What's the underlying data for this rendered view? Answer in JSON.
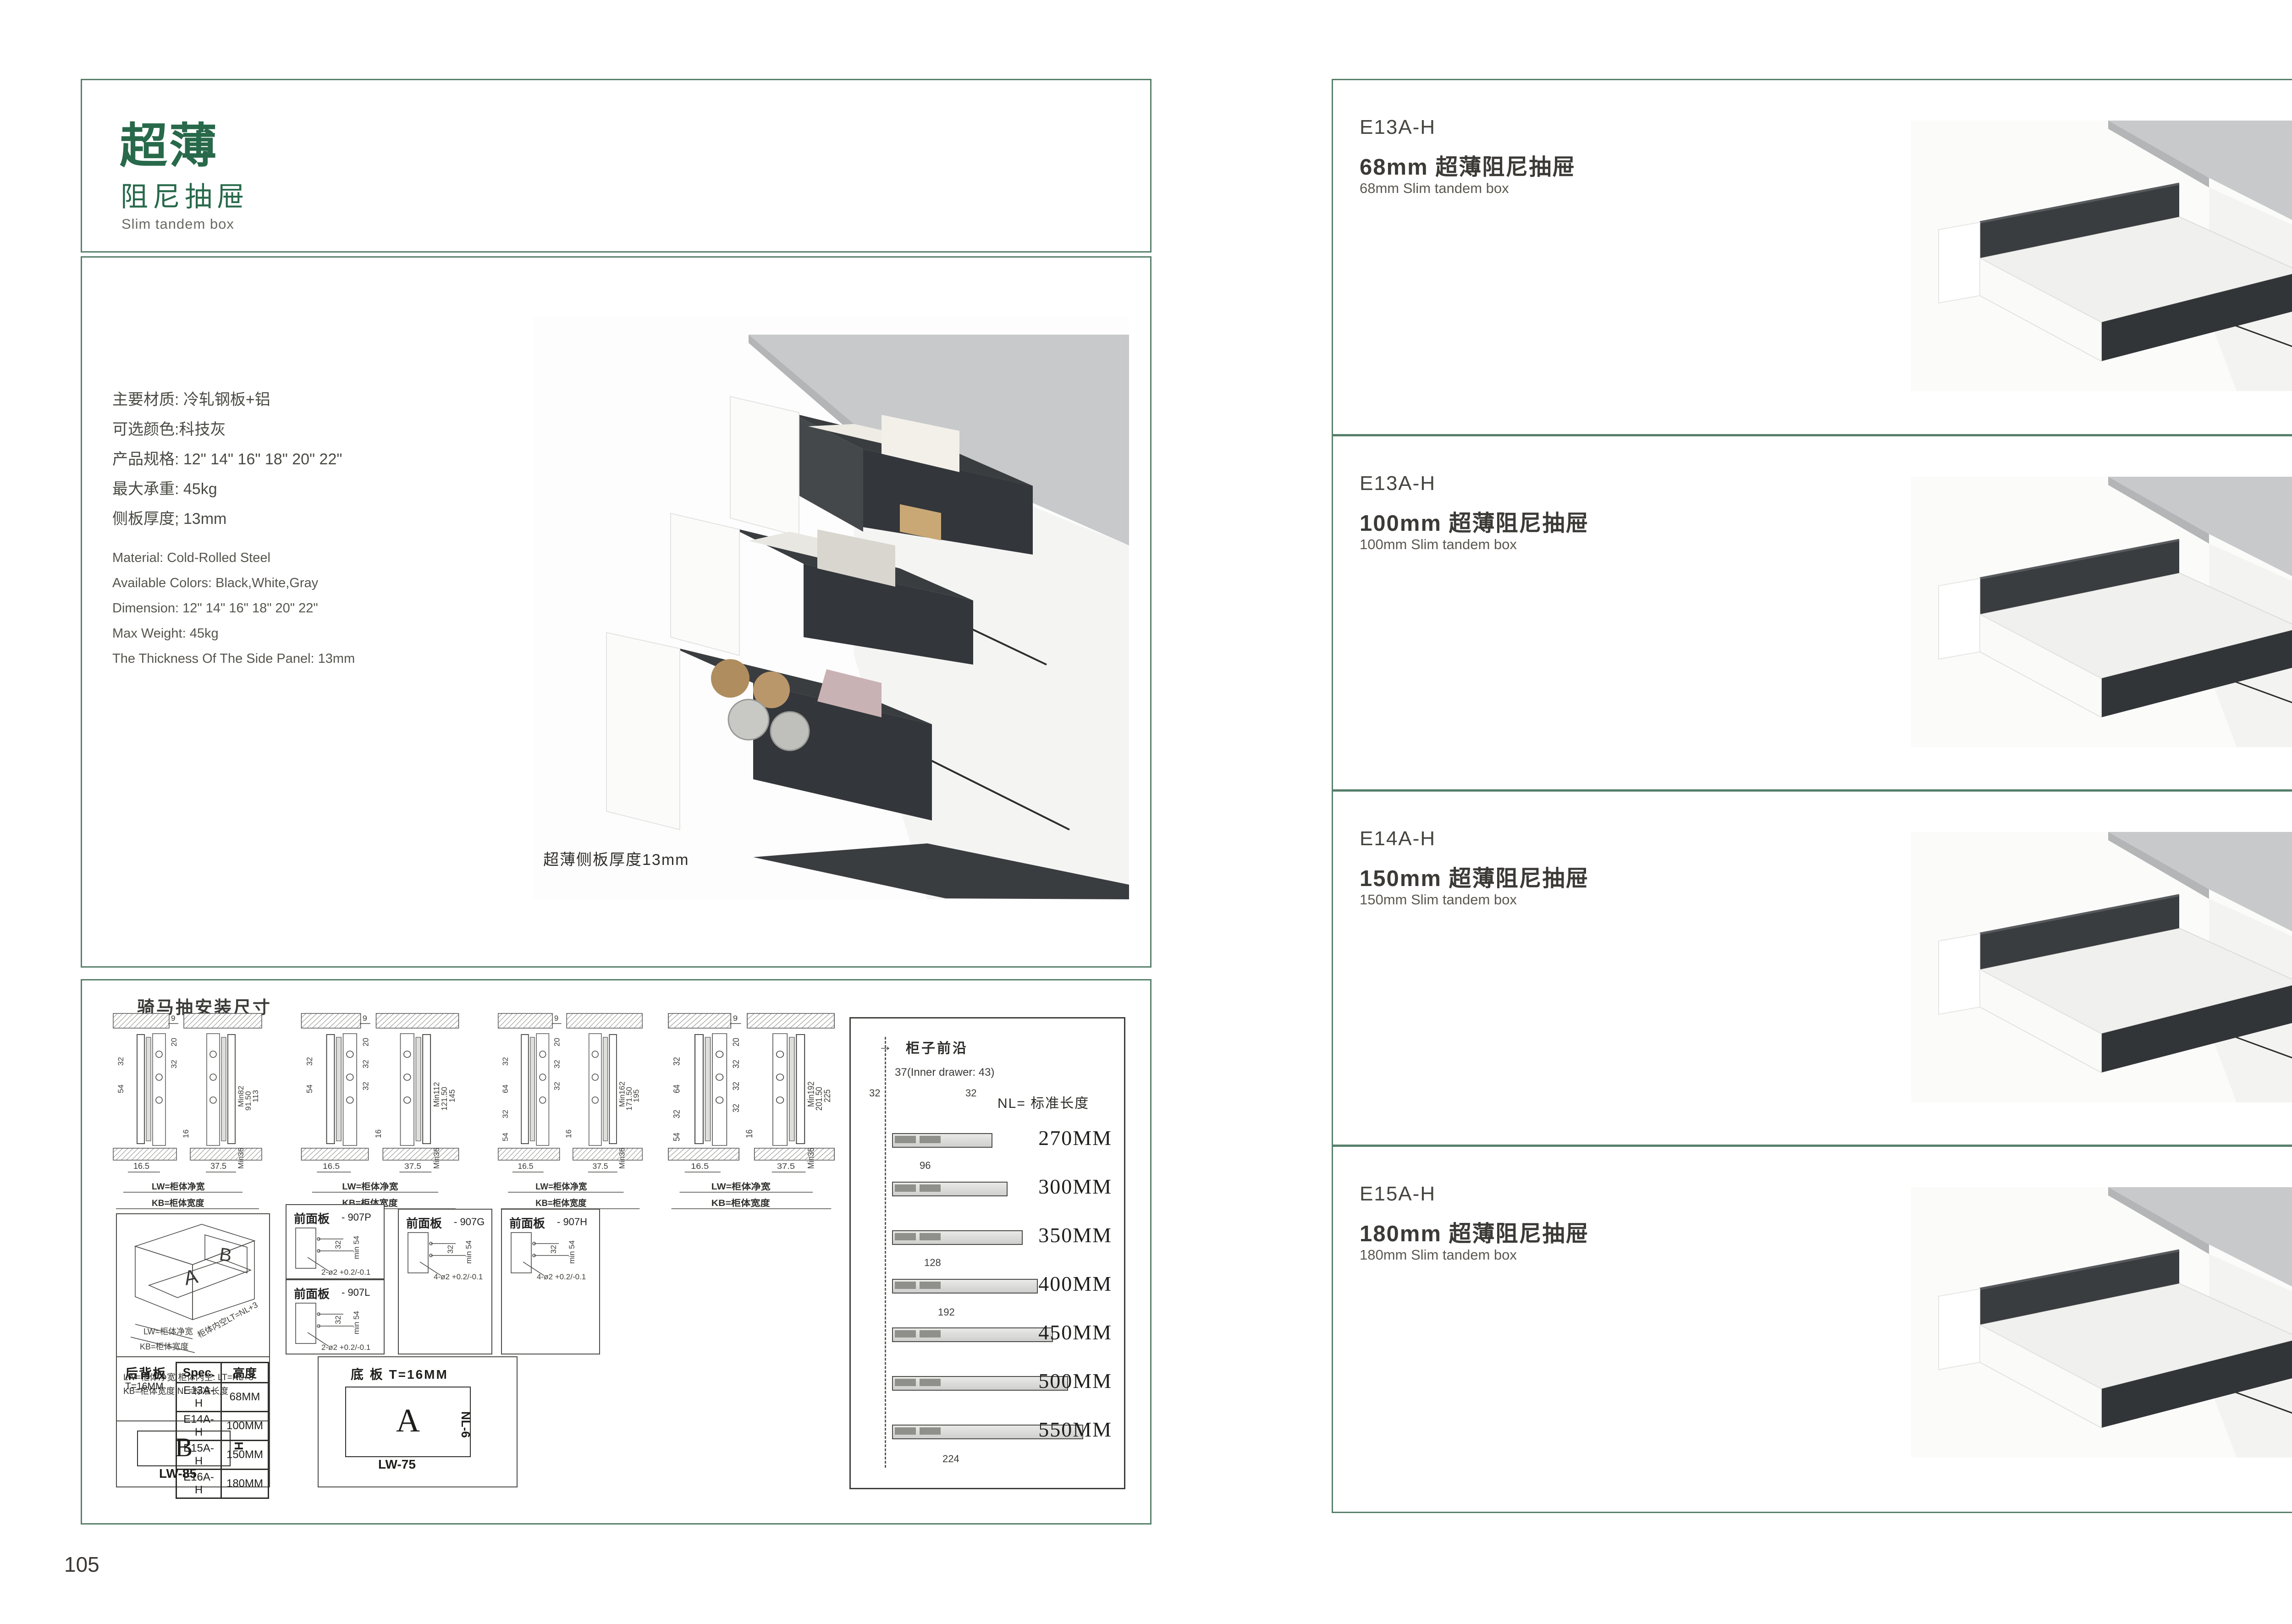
{
  "colors": {
    "accent_green": "#27694a",
    "border_green": "#577f6b",
    "charcoal": "#3a3d40",
    "countertop_gray": "#c9cbcc",
    "text_dark": "#3c3b37",
    "text_gray": "#5a584f"
  },
  "page_left": {
    "page_number": "105",
    "title": {
      "cn_main": "超薄",
      "cn_sub": "阻尼抽屉",
      "en": "Slim tandem box"
    },
    "specs_cn": [
      "主要材质: 冷轧钢板+铝",
      "可选颜色:科技灰",
      "产品规格: 12\" 14\" 16\" 18\" 20\" 22\"",
      "最大承重: 45kg",
      "侧板厚度; 13mm"
    ],
    "specs_en": [
      "Material: Cold-Rolled Steel",
      "Available Colors: Black,White,Gray",
      "Dimension: 12\" 14\" 16\" 18\" 20\" 22\"",
      "Max Weight: 45kg",
      "The Thickness Of The Side Panel: 13mm"
    ],
    "photo_caption": "超薄侧板厚度13mm",
    "drawings": {
      "header": "骑马抽安装尺寸",
      "sections": [
        {
          "t": "9",
          "c1": "20",
          "c2": "32",
          "c3": "",
          "c4": "",
          "l1": "32",
          "l2": "54",
          "l3": "",
          "l4": "",
          "m": "16",
          "r1": "Min82",
          "r2": "91.50",
          "r3": "113",
          "r4": "Min36",
          "b1": "16.5",
          "b2": "37.5",
          "lw": "LW=柜体净宽",
          "kb": "KB=柜体宽度"
        },
        {
          "t": "9",
          "c1": "20",
          "c2": "32",
          "c3": "32",
          "c4": "",
          "l1": "32",
          "l2": "54",
          "l3": "",
          "l4": "",
          "m": "16",
          "r1": "Min112",
          "r2": "121.50",
          "r3": "145",
          "r4": "Min36",
          "b1": "16.5",
          "b2": "37.5",
          "lw": "LW=柜体净宽",
          "kb": "KB=柜体宽度"
        },
        {
          "t": "9",
          "c1": "20",
          "c2": "32",
          "c3": "32",
          "c4": "",
          "l1": "32",
          "l2": "64",
          "l3": "32",
          "l4": "54",
          "m": "16",
          "r1": "Min162",
          "r2": "171.50",
          "r3": "195",
          "r4": "Min36",
          "b1": "16.5",
          "b2": "37.5",
          "lw": "LW=柜体净宽",
          "kb": "KB=柜体宽度"
        },
        {
          "t": "9",
          "c1": "20",
          "c2": "32",
          "c3": "32",
          "c4": "32",
          "l1": "32",
          "l2": "64",
          "l3": "32",
          "l4": "54",
          "m": "16",
          "r1": "Min192",
          "r2": "201.50",
          "r3": "225",
          "r4": "Min36",
          "b1": "16.5",
          "b2": "37.5",
          "lw": "LW=柜体净宽",
          "kb": "KB=柜体宽度"
        }
      ],
      "nl_panel": {
        "front_edge": "柜子前沿",
        "arrow": "→",
        "offset": "37(Inner drawer: 43)",
        "pitch_a": "32",
        "pitch_b": "32",
        "nl_label": "NL= 标准长度",
        "lengths": [
          "270MM",
          "300MM",
          "350MM",
          "400MM",
          "450MM",
          "500MM",
          "550MM"
        ],
        "dim_96": "96",
        "dim_128": "128",
        "dim_192": "192",
        "dim_224": "224"
      },
      "box3d": {
        "panel_a": "A",
        "panel_b": "B",
        "label_lw": "LW=柜体净宽",
        "label_kb": "KB=柜体宽度",
        "label_lt": "柜体内空LT=NL+3",
        "legend_line1": "LW=柜体净宽      柜体内空: LT=NL+3",
        "legend_line2": "KB=柜体宽度      NL=标准长度"
      },
      "front_panels": [
        {
          "t": "前面板",
          "code": "- 907P",
          "d1": "32",
          "d2": "",
          "d3": "",
          "m": "min 54",
          "holes": "2-ø2 +0.2/-0.1"
        },
        {
          "t": "前面板",
          "code": "- 907L",
          "d1": "32",
          "d2": "",
          "d3": "",
          "m": "min 54",
          "holes": "2-ø2 +0.2/-0.1"
        },
        {
          "t": "前面板",
          "code": "- 907G",
          "d1": "32",
          "d2": "64",
          "d3": "32",
          "m": "min 54",
          "holes": "4-ø2 +0.2/-0.1"
        },
        {
          "t": "前面板",
          "code": "- 907H",
          "d1": "32",
          "d2": "64",
          "d3": "32",
          "m": "min 54",
          "holes": "4-ø2 +0.2/-0.1"
        }
      ],
      "back_panel": {
        "label": "后背板",
        "thickness": "T=16MM",
        "table_headers": [
          "Spec.",
          "高度"
        ],
        "table_rows": [
          [
            "E13A-H",
            "68MM"
          ],
          [
            "E14A-H",
            "100MM"
          ],
          [
            "E15A-H",
            "150MM"
          ],
          [
            "E16A-H",
            "180MM"
          ]
        ],
        "rect_letter": "B",
        "h_label": "H",
        "width_label": "LW-85"
      },
      "bottom_panel": {
        "label": "底 板 T=16MM",
        "rect_letter": "A",
        "nl_label": "NL-6",
        "width_label": "LW-75"
      }
    }
  },
  "page_right": {
    "page_number": "106",
    "products": [
      {
        "code": "E13A-H",
        "title_cn": "68mm 超薄阻尼抽屉",
        "title_en": "68mm Slim tandem box"
      },
      {
        "code": "E13A-H",
        "title_cn": "100mm 超薄阻尼抽屉",
        "title_en": "100mm Slim tandem box"
      },
      {
        "code": "E14A-H",
        "title_cn": "150mm 超薄阻尼抽屉",
        "title_en": "150mm Slim tandem box"
      },
      {
        "code": "E15A-H",
        "title_cn": "180mm 超薄阻尼抽屉",
        "title_en": "180mm Slim tandem box"
      }
    ]
  }
}
